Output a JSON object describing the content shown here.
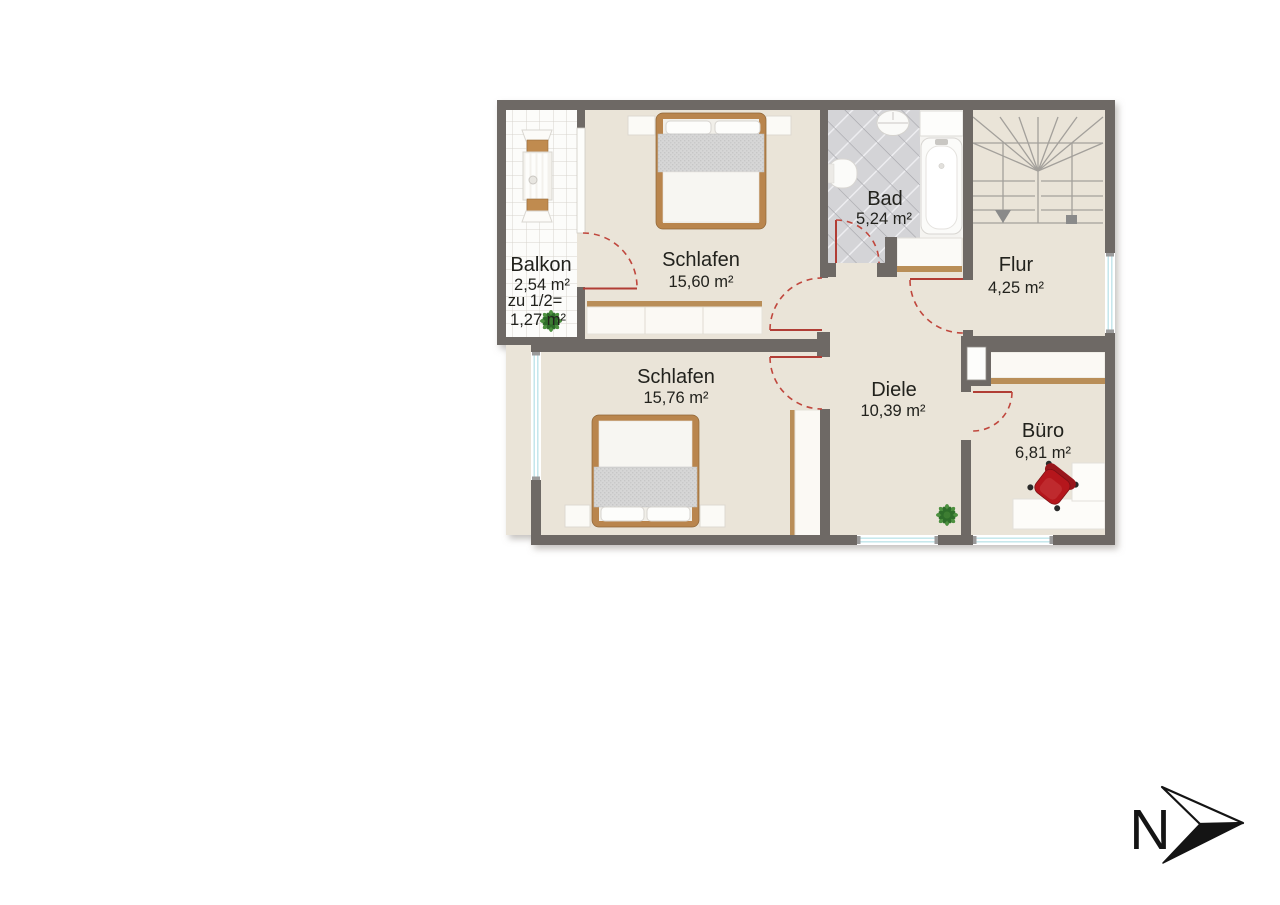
{
  "plan": {
    "compass": {
      "label": "N"
    },
    "rooms": {
      "balkon": {
        "name": "Balkon",
        "area": "2,54 m²",
        "half_label": "zu 1/2=",
        "half_area": "1,27 m²"
      },
      "schlafen1": {
        "name": "Schlafen",
        "area": "15,60 m²"
      },
      "bad": {
        "name": "Bad",
        "area": "5,24 m²"
      },
      "flur": {
        "name": "Flur",
        "area": "4,25 m²"
      },
      "schlafen2": {
        "name": "Schlafen",
        "area": "15,76 m²"
      },
      "diele": {
        "name": "Diele",
        "area": "10,39 m²"
      },
      "buero": {
        "name": "Büro",
        "area": "6,81 m²"
      }
    },
    "colors": {
      "wall": "#6e6965",
      "floor": "#eae4d8",
      "balcony_tile_line": "#d7d4cd",
      "bath_tile": "#d4d4d7",
      "door_red": "#c0463d",
      "wood": "#b98e58",
      "chair_red": "#b5191d",
      "plant_green": "#4e9140",
      "window_glass_line": "#bfe4ea",
      "text": "#20201e"
    }
  }
}
